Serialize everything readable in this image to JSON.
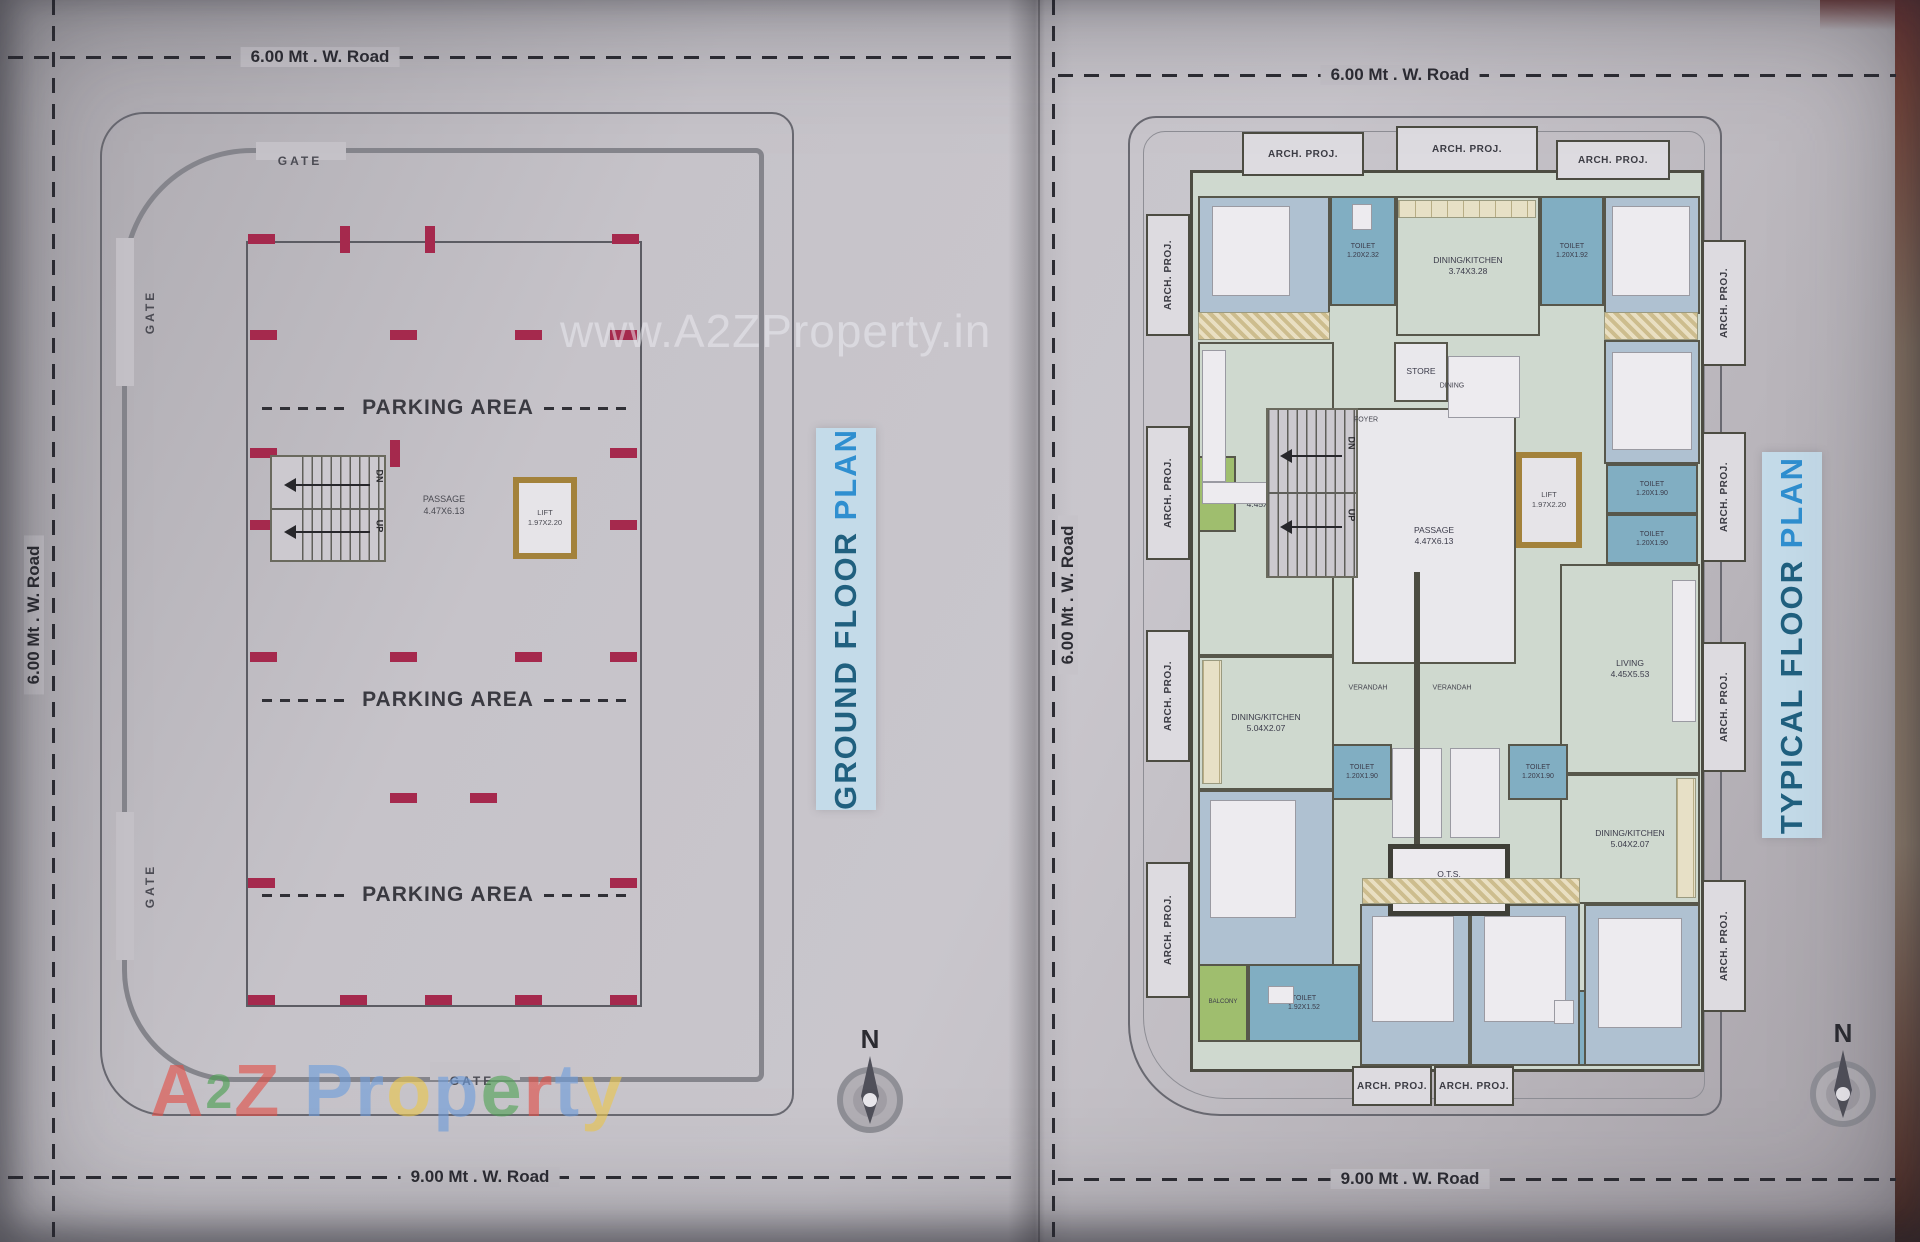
{
  "watermarks": {
    "center": "www.A2ZProperty.in",
    "brand_letters": [
      {
        "ch": "A",
        "c": "#e25048",
        "small": false
      },
      {
        "ch": "2",
        "c": "#4aa050",
        "small": true
      },
      {
        "ch": "Z",
        "c": "#e25048",
        "small": false
      },
      {
        "ch": " ",
        "c": "#ffffff",
        "small": false
      },
      {
        "ch": "P",
        "c": "#6f9edc",
        "small": false
      },
      {
        "ch": "r",
        "c": "#6f9edc",
        "small": false
      },
      {
        "ch": "o",
        "c": "#ecc84e",
        "small": false
      },
      {
        "ch": "p",
        "c": "#6f9edc",
        "small": false
      },
      {
        "ch": "e",
        "c": "#52a457",
        "small": false
      },
      {
        "ch": "r",
        "c": "#e25048",
        "small": false
      },
      {
        "ch": "t",
        "c": "#6f9edc",
        "small": false
      },
      {
        "ch": "y",
        "c": "#ecc84e",
        "small": false
      }
    ]
  },
  "roads": {
    "gf_top": "6.00 Mt . W. Road",
    "gf_left": "6.00 Mt . W. Road",
    "gf_bottom": "9.00 Mt . W. Road",
    "tf_top": "6.00 Mt . W. Road",
    "tf_left": "6.00 Mt . W. Road",
    "tf_bottom": "9.00 Mt . W. Road"
  },
  "ground_floor": {
    "title_main": "GROUND FLOOR ",
    "title_accent": "PLAN",
    "gate": "GATE",
    "parking": "PARKING AREA",
    "passage_name": "PASSAGE",
    "passage_dim": "4.47X6.13",
    "lift_name": "LIFT",
    "lift_dim": "1.97X2.20",
    "up": "UP",
    "dn": "DN",
    "north": "N"
  },
  "typical_floor": {
    "title_main": "TYPICAL FLOOR ",
    "title_accent": "PLAN",
    "arch_proj": "ARCH. PROJ.",
    "up": "UP",
    "dn": "DN",
    "north": "N",
    "rooms": {
      "bed_tl": {
        "name": "BED ROOM",
        "dim": "3.00X3.16"
      },
      "toilet_tl": {
        "name": "TOILET",
        "dim": "1.20X2.32"
      },
      "kitchen_top": {
        "name": "DINING/KITCHEN",
        "dim": "3.74X3.28"
      },
      "toilet_tr": {
        "name": "TOILET",
        "dim": "1.20X1.92"
      },
      "bed_tr": {
        "name": "BED ROOM",
        "dim": "2.78X3.30"
      },
      "bed_r2": {
        "name": "BED ROOM",
        "dim": "3.38X3.28"
      },
      "toilet_r1": {
        "name": "TOILET",
        "dim": "1.20X1.90"
      },
      "toilet_r2": {
        "name": "TOILET",
        "dim": "1.20X1.90"
      },
      "living_r": {
        "name": "LIVING",
        "dim": "4.45X5.53"
      },
      "dining_r": {
        "name": "DINING/KITCHEN",
        "dim": "5.04X2.07"
      },
      "bed_br": {
        "name": "BED ROOM",
        "dim": "2.72X3.48"
      },
      "toilet_br": {
        "name": "TOILET",
        "dim": "1.92X1.52"
      },
      "living_l": {
        "name": "LIVING",
        "dim": "4.45X5.53"
      },
      "dining_l": {
        "name": "DINING/KITCHEN",
        "dim": "5.04X2.07"
      },
      "bed_bl": {
        "name": "BED ROOM",
        "dim": "2.72X3.48"
      },
      "toilet_bl": {
        "name": "TOILET",
        "dim": "1.92X1.52"
      },
      "balcony_bl": {
        "name": "BALCONY",
        "dim": ""
      },
      "balcony_l": {
        "name": "BALCONY",
        "dim": ""
      },
      "bed_b1": {
        "name": "BED ROOM",
        "dim": "3.43X3.48"
      },
      "bed_b2": {
        "name": "BED ROOM",
        "dim": "3.43X3.48"
      },
      "toilet_c1": {
        "name": "TOILET",
        "dim": "1.20X1.90"
      },
      "toilet_c2": {
        "name": "TOILET",
        "dim": "1.20X1.90"
      },
      "passage": {
        "name": "PASSAGE",
        "dim": "4.47X6.13"
      },
      "lift": {
        "name": "LIFT",
        "dim": "1.97X2.20"
      },
      "store": {
        "name": "STORE",
        "dim": ""
      },
      "dining_c": {
        "name": "DINING",
        "dim": ""
      },
      "foyer": {
        "name": "FOYER",
        "dim": ""
      },
      "ots": {
        "name": "O.T.S.",
        "dim": "1.90X1.20"
      },
      "verandah1": {
        "name": "VERANDAH",
        "dim": ""
      },
      "verandah2": {
        "name": "VERANDAH",
        "dim": ""
      }
    }
  }
}
